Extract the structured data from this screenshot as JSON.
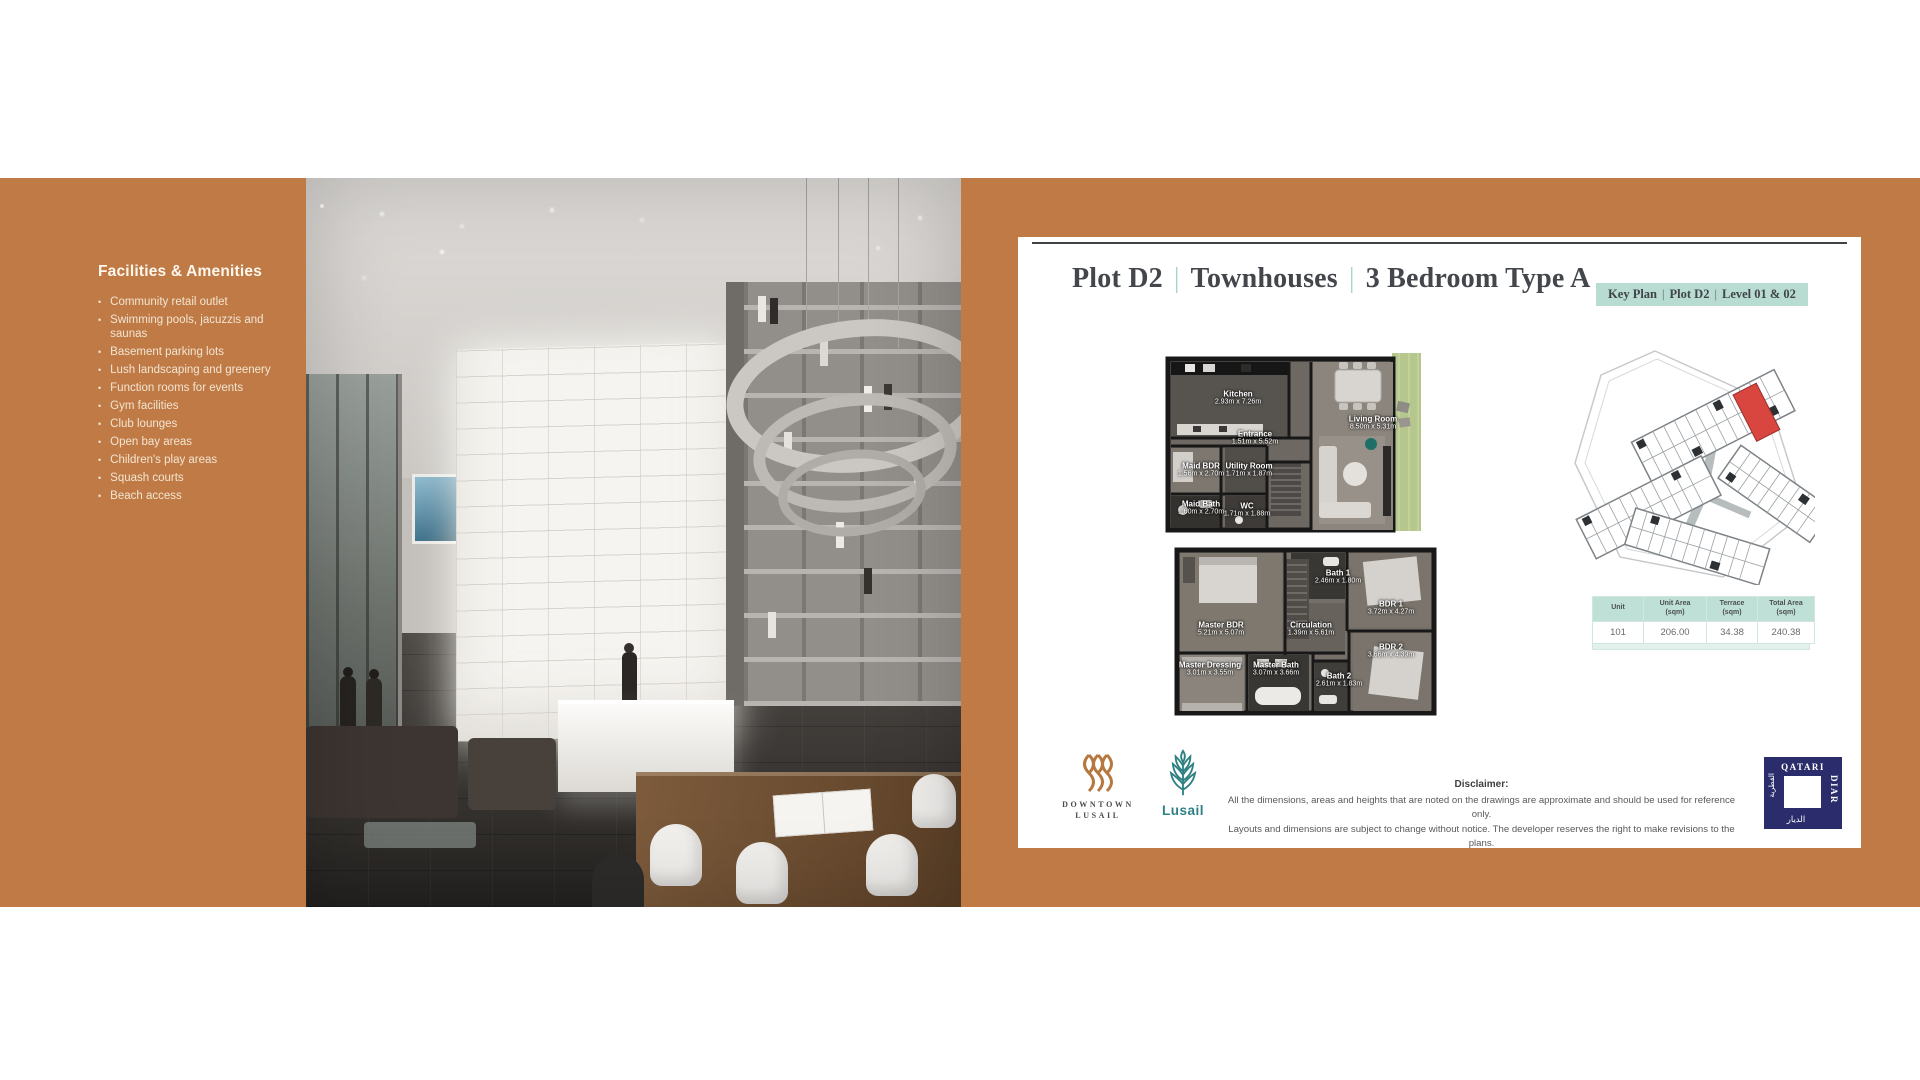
{
  "colors": {
    "band_orange": "#bf7a45",
    "mint": "#b9dcd2",
    "title_text": "#43474c",
    "red_unit": "#d9453f",
    "terrace_green": "#b6c78e",
    "lusail_teal": "#2e8083",
    "qatari_navy": "#2b2c6b",
    "downtown_gold": "#b5793f"
  },
  "sidebar": {
    "heading": "Facilities & Amenities",
    "bullet": "•",
    "items": [
      "Community retail outlet",
      "Swimming pools, jacuzzis and saunas",
      "Basement parking lots",
      "Lush landscaping and greenery",
      "Function rooms for events",
      "Gym facilities",
      "Club lounges",
      "Open bay areas",
      "Children's play areas",
      "Squash courts",
      "Beach access"
    ]
  },
  "panel": {
    "title": {
      "plot": "Plot D2",
      "type": "Townhouses",
      "bedroom": "3 Bedroom Type A",
      "sep": "|"
    },
    "keytag": {
      "part1": "Key Plan",
      "part2": "Plot D2",
      "part3": "Level 01 & 02",
      "sep": "|"
    }
  },
  "floorplans": {
    "level1": {
      "rooms": [
        {
          "name": "Kitchen",
          "dims": "2.93m x 7.26m"
        },
        {
          "name": "Entrance",
          "dims": "1.51m x 5.52m"
        },
        {
          "name": "Living Room",
          "dims": "8.50m x 5.31m"
        },
        {
          "name": "Maid BDR",
          "dims": "1.56m x 2.70m"
        },
        {
          "name": "Utility Room",
          "dims": "1.71m x 1.87m"
        },
        {
          "name": "Maid Bath",
          "dims": "1.60m x 2.70m"
        },
        {
          "name": "WC",
          "dims": "1.71m x 1.88m"
        }
      ]
    },
    "level2": {
      "rooms": [
        {
          "name": "Master BDR",
          "dims": "5.21m x 5.07m"
        },
        {
          "name": "Bath 1",
          "dims": "2.46m x 1.80m"
        },
        {
          "name": "BDR 1",
          "dims": "3.72m x 4.27m"
        },
        {
          "name": "Circulation",
          "dims": "1.39m x 5.61m"
        },
        {
          "name": "Master Dressing",
          "dims": "3.01m x 3.55m"
        },
        {
          "name": "Master Bath",
          "dims": "3.07m x 3.66m"
        },
        {
          "name": "Bath 2",
          "dims": "2.61m x 1.83m"
        },
        {
          "name": "BDR 2",
          "dims": "3.66m x 4.39m"
        }
      ]
    }
  },
  "unit_table": {
    "headers": [
      {
        "l1": "Unit",
        "l2": ""
      },
      {
        "l1": "Unit Area",
        "l2": "(sqm)"
      },
      {
        "l1": "Terrace",
        "l2": "(sqm)"
      },
      {
        "l1": "Total Area",
        "l2": "(sqm)"
      }
    ],
    "row": [
      "101",
      "206.00",
      "34.38",
      "240.38"
    ]
  },
  "logos": {
    "downtown_line1": "DOWNTOWN",
    "downtown_line2": "LUSAIL",
    "lusail_word": "Lusail",
    "qatari_top": "QATARI",
    "qatari_side": "DIAR",
    "qatari_arabic_side": "القطرية",
    "qatari_arabic_bottom": "الديار"
  },
  "disclaimer": {
    "title": "Disclaimer:",
    "line1": "All the dimensions, areas and heights that are noted on the drawings are approximate and should be used for reference only.",
    "line2": "Layouts and dimensions are subject to change without notice. The developer reserves the right to make revisions to the plans."
  }
}
